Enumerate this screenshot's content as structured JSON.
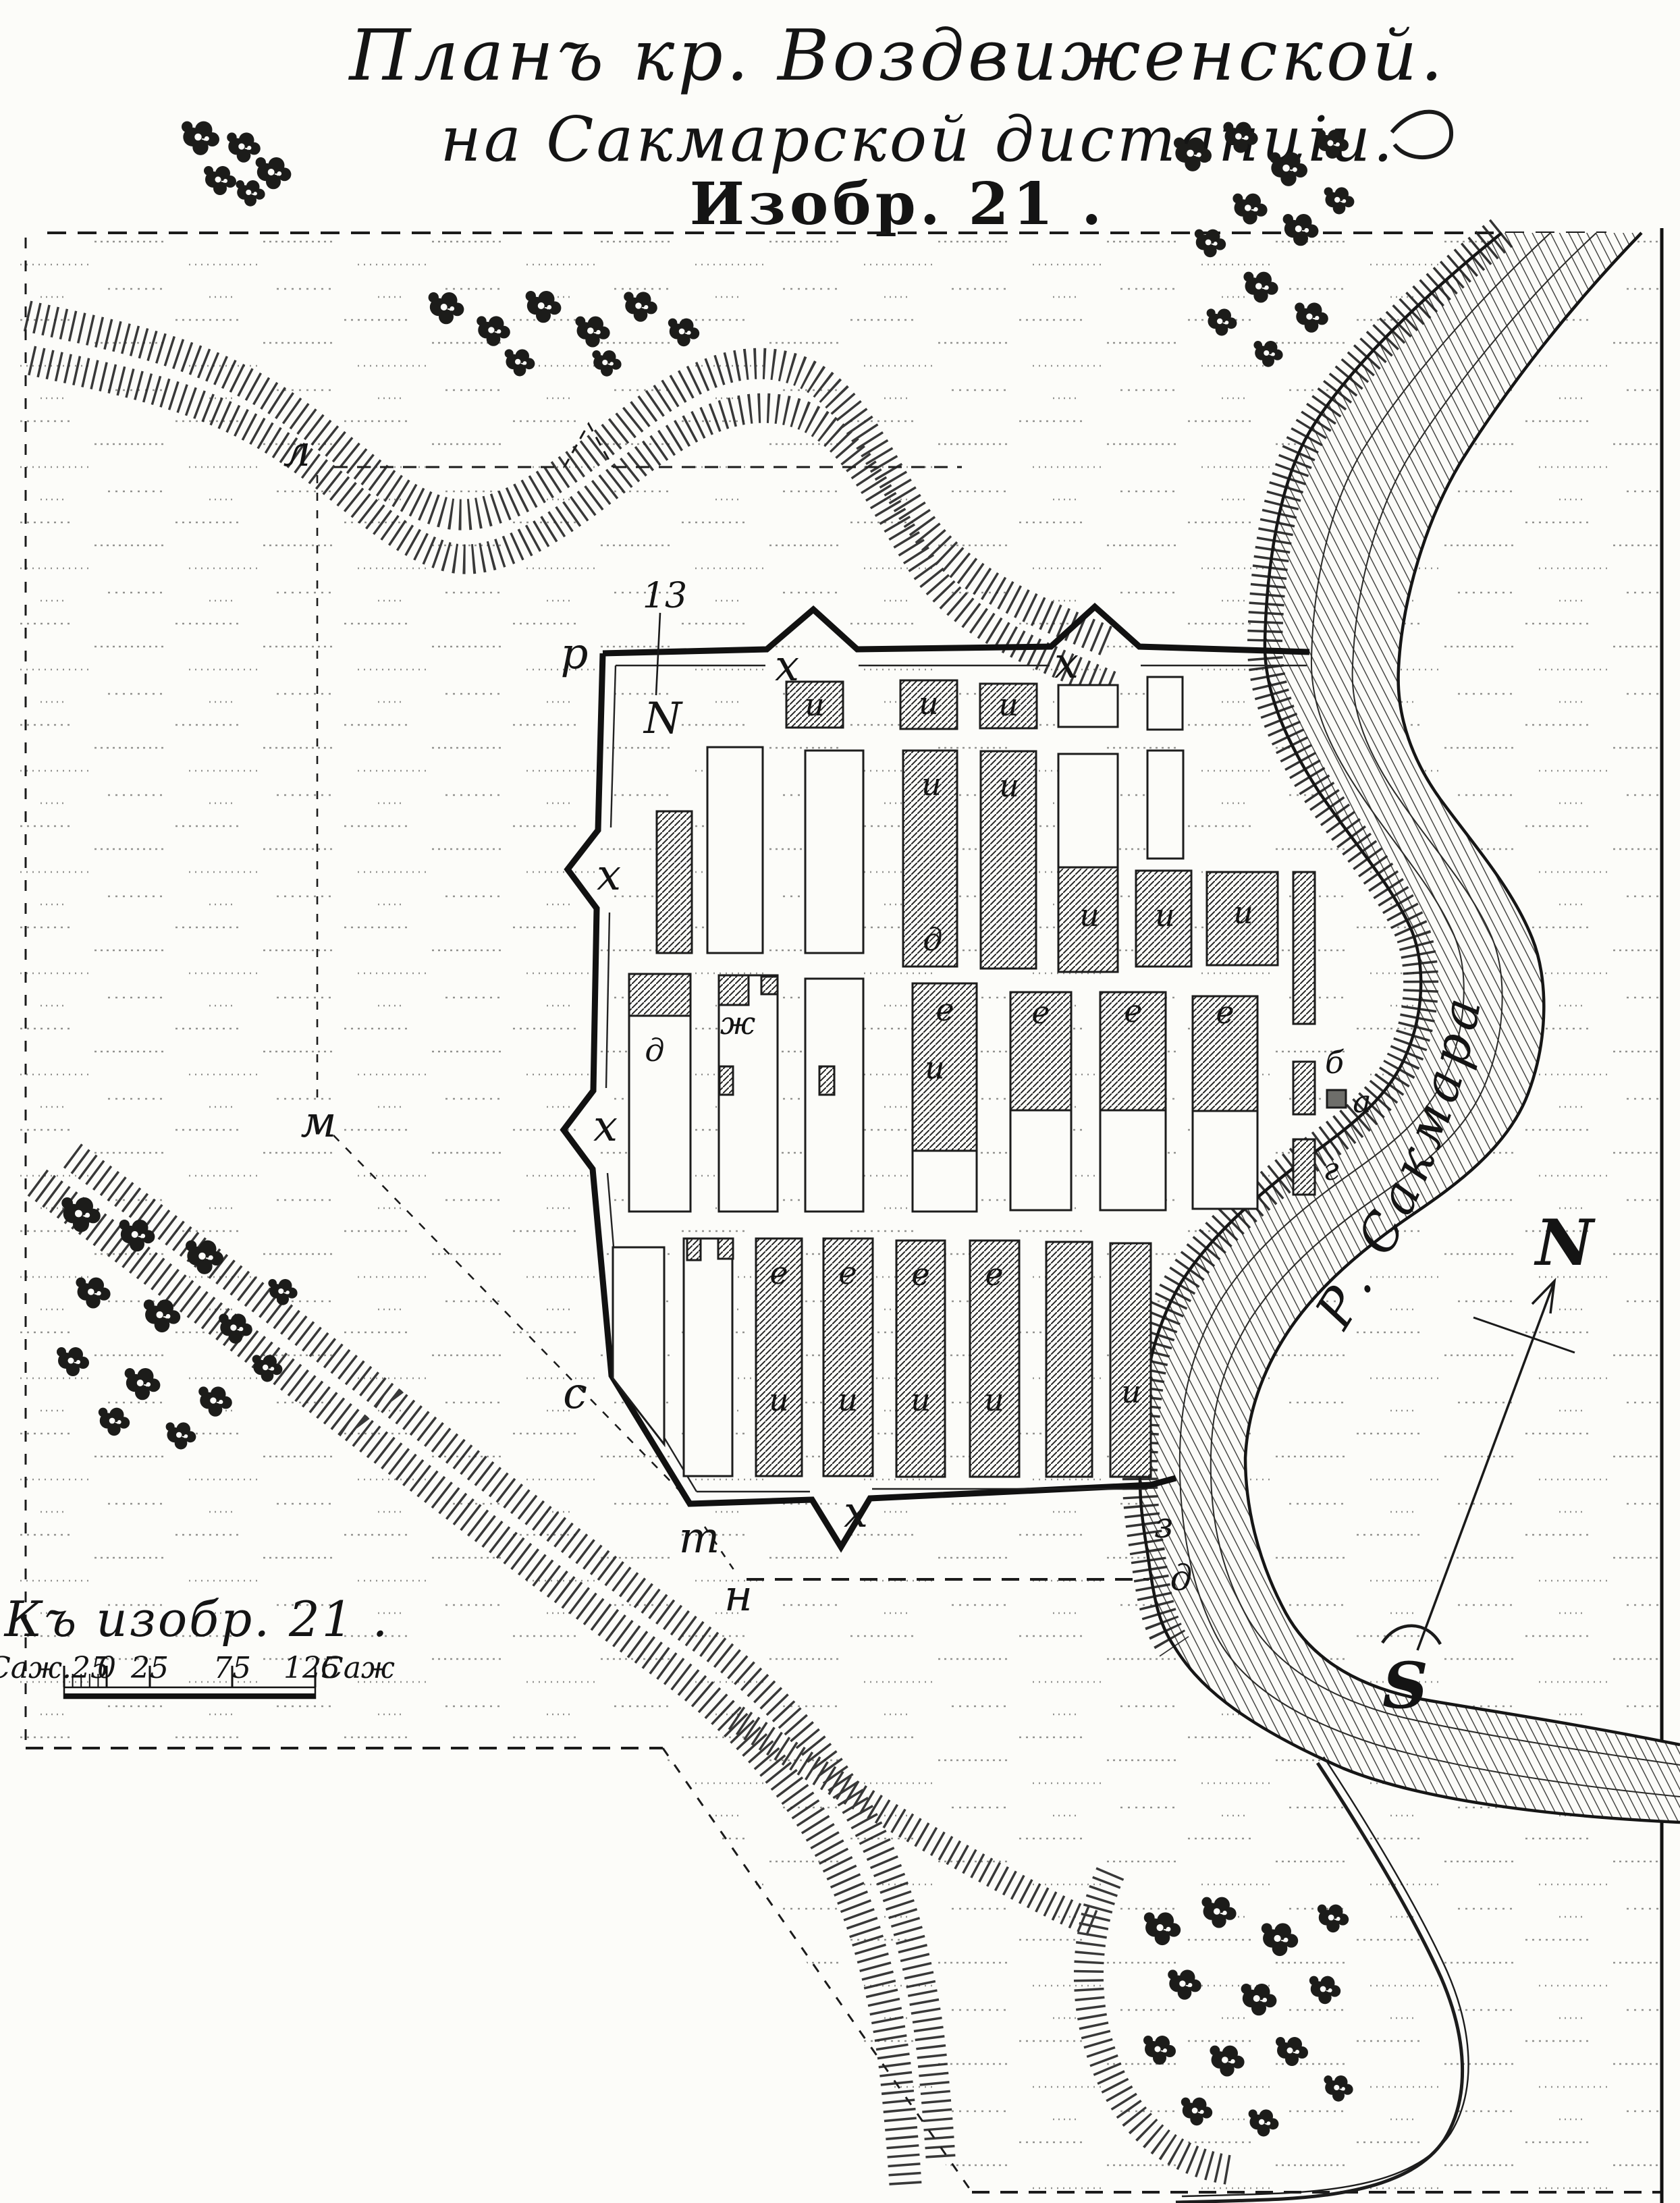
{
  "title": {
    "line1": "Планъ кр. Воздвиженской.",
    "line2": "на Сакмарской дистанціи.",
    "line3": "Изобр. 21 ."
  },
  "scale": {
    "caption": "Къ изобр. 21 .",
    "left_label": "Саж.25",
    "ticks": [
      "0",
      "25",
      "75",
      "125"
    ],
    "right_unit": "Саж",
    "unit_system": "sazhen"
  },
  "compass": {
    "north": "N",
    "south": "S"
  },
  "river": {
    "name": "Р. Сакмара"
  },
  "plan_labels": {
    "r": "р",
    "x": "х",
    "s": "с",
    "t": "т",
    "n": "н",
    "l": "л",
    "m": "м",
    "ref_number": "13",
    "ref_letter": "N",
    "z": "з",
    "d": "д"
  },
  "block_labels": {
    "a": "а",
    "b": "б",
    "g": "г",
    "d": "д",
    "e": "е",
    "zh": "ж",
    "i": "и"
  },
  "ink_color": "#1a1a1a",
  "paper_color": "#fcfcf9"
}
